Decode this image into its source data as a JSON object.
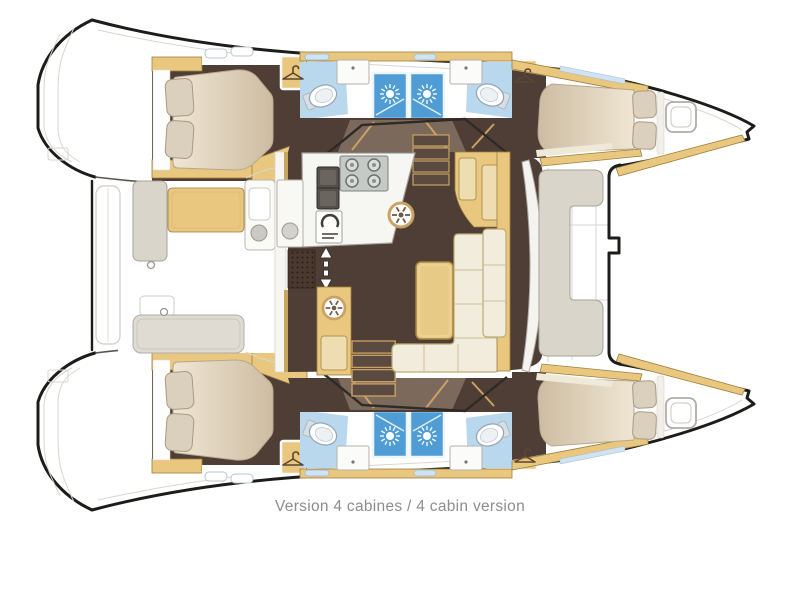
{
  "caption": "Version 4 cabines / 4 cabin version",
  "plan": {
    "type": "catamaran-floor-plan",
    "view": "top-down",
    "bow_direction": "right",
    "visible_counts": {
      "cabins": 4,
      "double_beds": 4,
      "showers": 4,
      "toilets": 4,
      "sinks": 4,
      "wardrobe_lockers": 4,
      "bow_hatches": 2
    }
  },
  "icons": {
    "shower": "starburst-sun",
    "wardrobe": "clothes-hanger",
    "companionway": "up-down-arrow",
    "stove": "four-burner-cooktop",
    "floor_hatch": "spoked-wheel",
    "deck_hatch": "rounded-square"
  },
  "colors": {
    "outline": "#1d1c1a",
    "deck_line": "#d9d6d0",
    "wood": "#e9c77e",
    "wood_dark": "#9c7f3f",
    "wood_deep": "#c9a264",
    "floor": "#4f3e35",
    "floor_taupe": "#7b695c",
    "bath": "#b9d8ee",
    "shower": "#4f9dd4",
    "counter": "#f6f6f3",
    "counter_edge": "#a3a09a",
    "cream": "#f1ecdb",
    "cream_edge": "#bcab77",
    "gray_fill": "#d9d5cb",
    "gray_edge": "#a8a39a",
    "pillow": "#dbcfbd",
    "pillow_edge": "#a99b83",
    "mattress_hi": "#efe6d3",
    "mattress_lo": "#cdbca2",
    "mattress_edge": "#b7a78e",
    "caption": "#8d8d8d"
  }
}
